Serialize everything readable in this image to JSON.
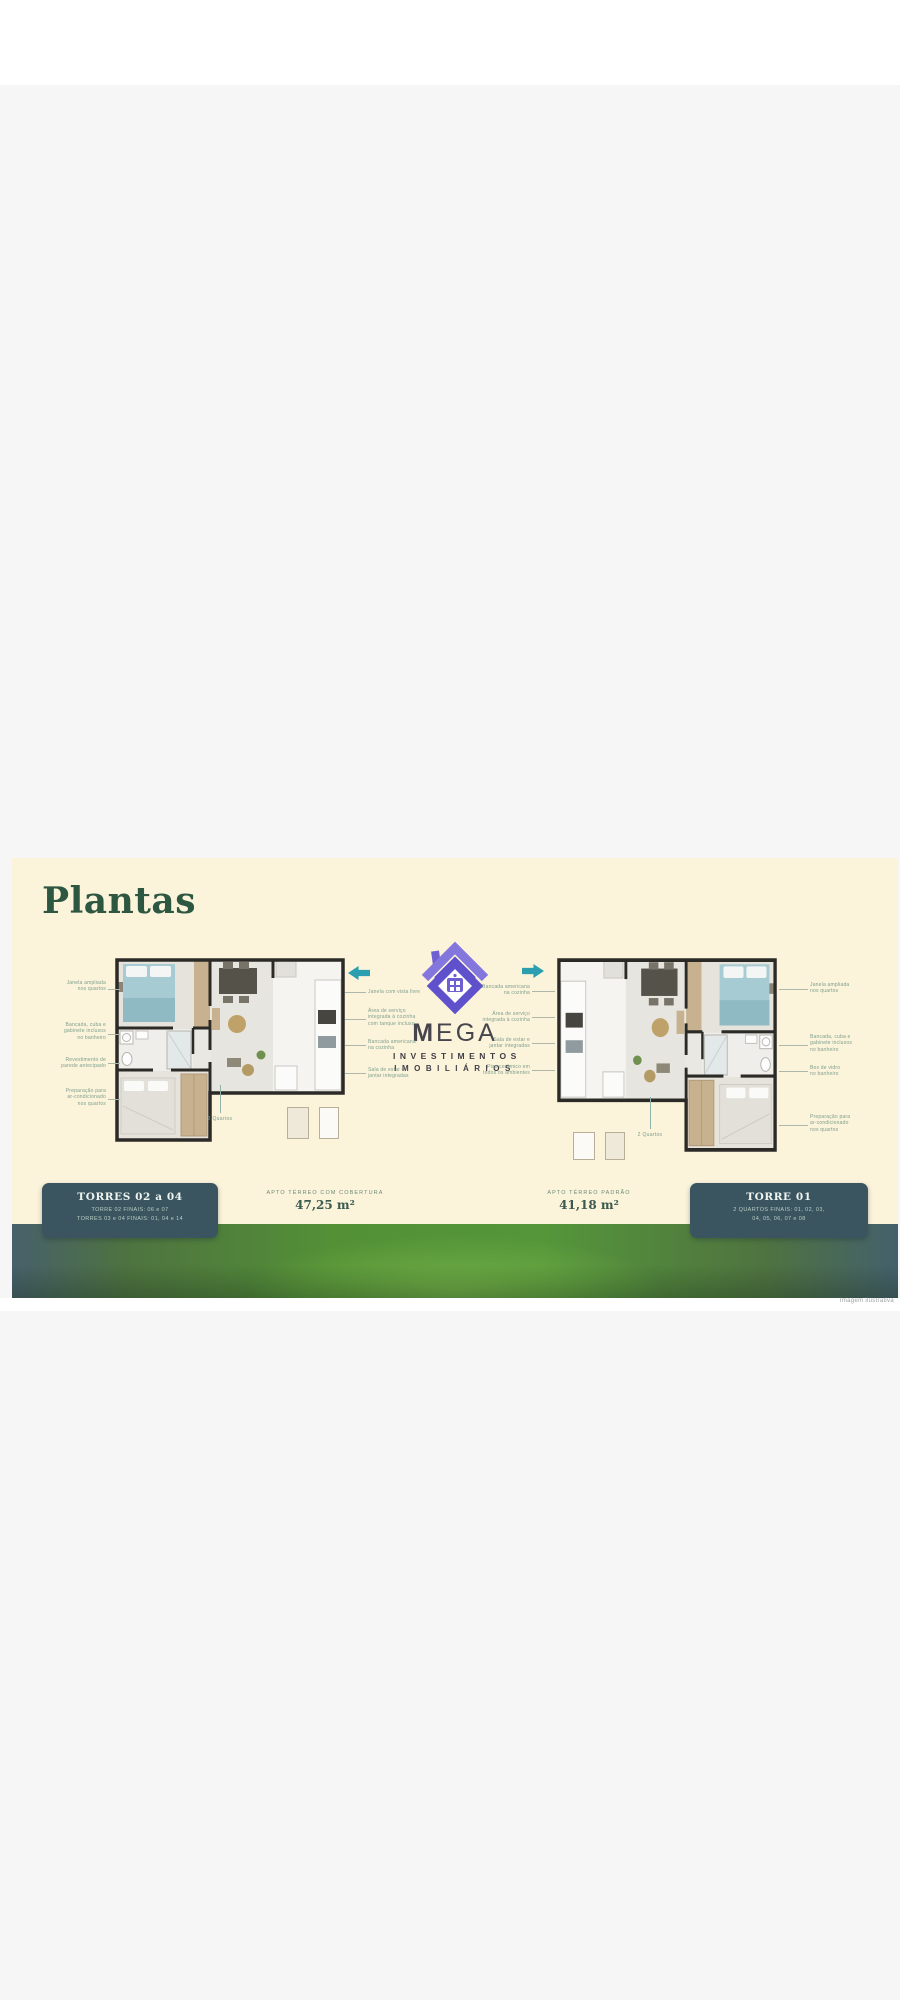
{
  "page": {
    "title": "Plantas",
    "credit": "Imagem ilustrativa"
  },
  "logo": {
    "m": "M",
    "ega": "EGA",
    "line1": "INVESTIMENTOS",
    "line2": "IMOBILIÁRIOS"
  },
  "plans": {
    "left": {
      "caption": "APTO TÉRREO COM COBERTURA",
      "area": "47,25 m²",
      "footnote": "2 Quartos",
      "box": {
        "title": "TORRES 02 a 04",
        "lines": "TORRE 02 FINAIS: 06 e 07\nTORRES 03 e 04 FINAIS: 01, 04 e 14"
      },
      "annotations_left": [
        "Janela ampliada\nnos quartos",
        "Bancada, cuba e\ngabinete inclusos\nno banheiro",
        "Revestimento de\nparede antecipado",
        "Preparação para\nar-condicionado\nnos quartos"
      ],
      "annotations_right": [
        "Janela com vista livre",
        "Área de serviço\nintegrada à cozinha\ncom tanque incluso",
        "Bancada americana\nna cozinha",
        "Sala de estar e\njantar integradas"
      ]
    },
    "right": {
      "caption": "APTO TÉRREO PADRÃO",
      "area": "41,18 m²",
      "footnote": "2 Quartos",
      "box": {
        "title": "TORRE 01",
        "lines": "2 QUARTOS FINAIS: 01, 02, 03,\n04, 05, 06, 07 e 08"
      },
      "annotations_left": [
        "Bancada americana\nna cozinha",
        "Área de serviço\nintegrada à cozinha",
        "Sala de estar e\njantar integradas",
        "Piso cerâmico em\ntodos os ambientes"
      ],
      "annotations_right": [
        "Janela ampliada\nnos quartos",
        "Bancada, cuba e\ngabinete inclusos\nno banheiro",
        "Box de vidro\nno banheiro",
        "Preparação para\nar-condicionado\nnos quartos"
      ]
    }
  },
  "colors": {
    "band_bg": "#fbf3da",
    "accent_teal": "#2b9fb0",
    "box_bg": "#3a5560",
    "title_green": "#2d5741",
    "logo_purple": "#6f60d2",
    "grass_green": "#55963a"
  }
}
